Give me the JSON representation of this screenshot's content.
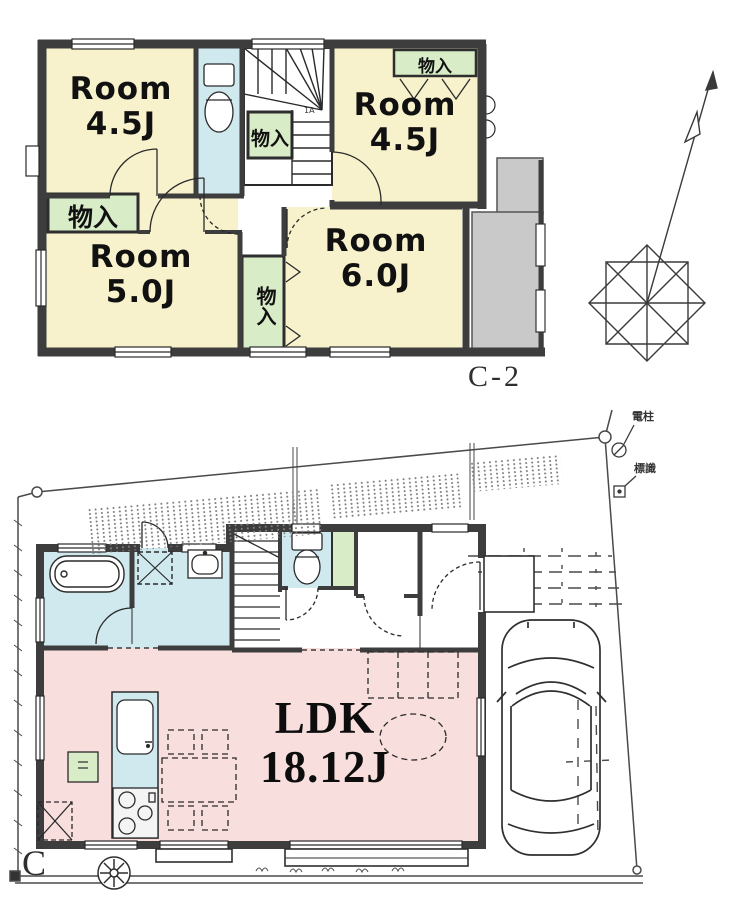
{
  "colors": {
    "wall": "#3d3d3d",
    "room_yellow": "#f7f2cc",
    "closet_green": "#d9ecc8",
    "water_blue": "#cfe9ef",
    "ldk_pink": "#f9dede",
    "balcony_gray": "#c9c9c9",
    "line_gray": "#4a4a4a"
  },
  "floor2": {
    "plan_label": "C-2",
    "room_tl": {
      "line1": "Room",
      "line2": "4.5J"
    },
    "room_tr": {
      "line1": "Room",
      "line2": "4.5J"
    },
    "room_bl": {
      "line1": "Room",
      "line2": "5.0J"
    },
    "room_br": {
      "line1": "Room",
      "line2": "6.0J"
    },
    "closet_tr_label": "物入",
    "closet_left_label": "物入",
    "closet_mid_label": "物入",
    "closet_stairs_label": "物入",
    "stair_note": "1A"
  },
  "floor1": {
    "plan_label": "C",
    "ldk": {
      "line1": "LDK",
      "line2": "18.12J"
    },
    "pole_label": "電柱",
    "sign_label": "標識"
  }
}
